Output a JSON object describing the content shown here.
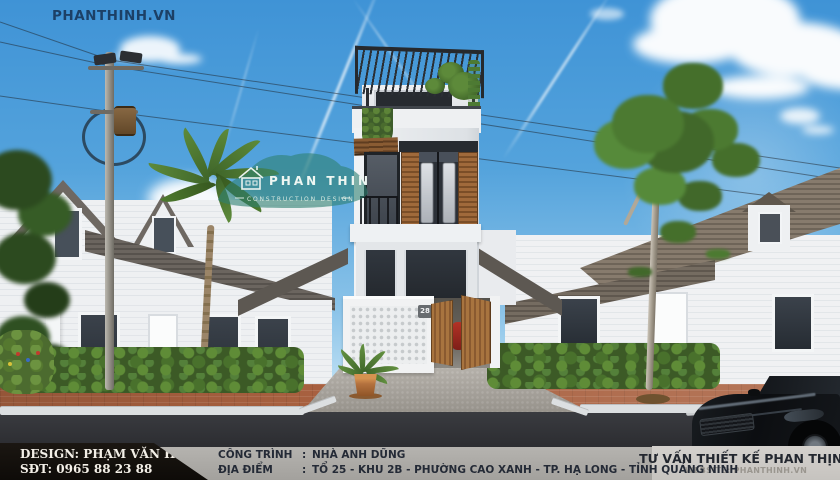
{
  "scene": {
    "site_watermark": "PHANTHINH.VN",
    "logo": {
      "title": "PHAN THINH",
      "subtitle": "CONSTRUCTION DESIGN"
    },
    "house_number": "28"
  },
  "footer": {
    "credits": {
      "design": "DESIGN: PHẠM VĂN HƯNG",
      "phone": "SĐT: 0965 88 23 88"
    },
    "project": {
      "rows": [
        {
          "label": "CÔNG TRÌNH",
          "colon": ":",
          "value": "NHÀ ANH DŨNG"
        },
        {
          "label": "ĐỊA ĐIỂM",
          "colon": ":",
          "value": "TỔ 25 - KHU 2B - PHƯỜNG CAO XANH - TP. HẠ LONG - TỈNH QUẢNG NINH"
        }
      ]
    },
    "consultant": {
      "title": "TƯ VẤN THIẾT KẾ PHAN THỊNH",
      "website": "WEBSITE: PHANTHINH.VN"
    }
  },
  "colors": {
    "sky_top": "#3f93d6",
    "sky_horizon": "#d9edf8",
    "logo_teal": "#2f8172",
    "footer_black": "#12100d",
    "footer_gray": "#a9a7a3",
    "footer_light": "#cecbc7",
    "watermark_blue": "#1c4066"
  }
}
